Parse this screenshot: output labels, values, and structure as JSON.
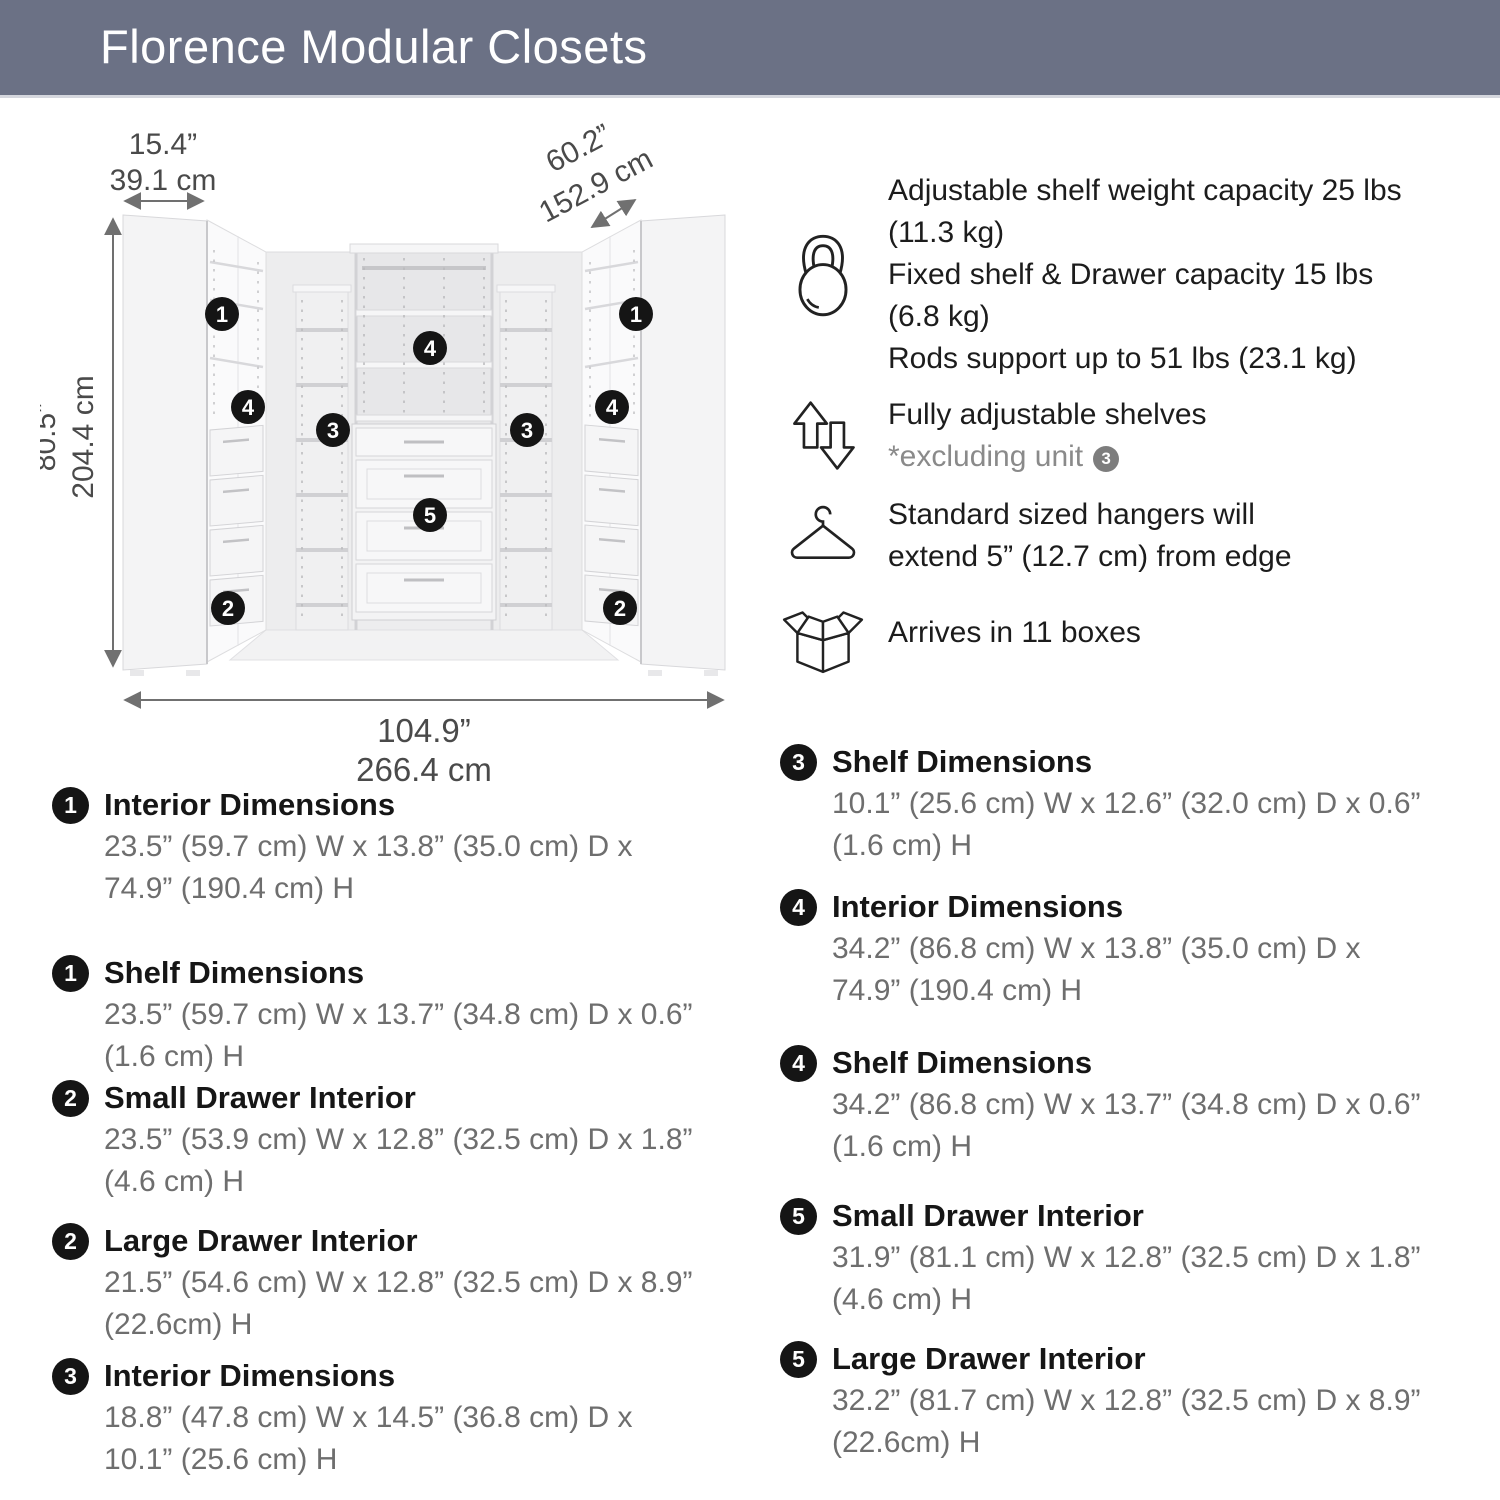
{
  "header": {
    "title": "Florence Modular Closets"
  },
  "colors": {
    "header_bg": "#6b7185",
    "badge_bg": "#151515",
    "note_badge_bg": "#7d7d7d",
    "body_gray": "#6e6e6e",
    "dimension_gray": "#4a4a4a"
  },
  "diagram": {
    "width_top_small": {
      "in": "15.4”",
      "cm": "39.1 cm"
    },
    "width_top_angled": {
      "in": "60.2”",
      "cm": "152.9 cm"
    },
    "height_left": {
      "in": "80.5”",
      "cm": "204.4 cm"
    },
    "width_bottom": {
      "in": "104.9”",
      "cm": "266.4 cm"
    },
    "callouts": {
      "c1": "1",
      "c2": "2",
      "c3": "3",
      "c4": "4",
      "c5": "5"
    }
  },
  "features": [
    {
      "icon": "kettlebell-icon",
      "lines": [
        "Adjustable shelf weight capacity 25 lbs (11.3 kg)",
        "Fixed shelf & Drawer capacity 15 lbs (6.8 kg)",
        "Rods support up to 51 lbs (23.1 kg)"
      ]
    },
    {
      "icon": "adjustable-arrows-icon",
      "title": "Fully adjustable shelves",
      "note": "*excluding unit",
      "note_badge": "3"
    },
    {
      "icon": "hanger-icon",
      "text": "Standard sized hangers will extend 5” (12.7 cm) from edge"
    },
    {
      "icon": "box-icon",
      "text": "Arrives in 11 boxes"
    }
  ],
  "specs": {
    "left": [
      {
        "badge": "1",
        "title": "Interior Dimensions",
        "dims": "23.5” (59.7 cm) W x 13.8” (35.0 cm) D x 74.9” (190.4 cm) H"
      },
      {
        "badge": "1",
        "title": "Shelf Dimensions",
        "dims": "23.5” (59.7 cm) W x 13.7” (34.8 cm) D x 0.6” (1.6 cm) H"
      },
      {
        "badge": "2",
        "title": "Small Drawer Interior",
        "dims": "23.5” (53.9 cm) W x 12.8” (32.5 cm) D x 1.8” (4.6 cm) H"
      },
      {
        "badge": "2",
        "title": "Large Drawer Interior",
        "dims": "21.5” (54.6 cm) W x 12.8” (32.5 cm) D x 8.9” (22.6cm) H"
      },
      {
        "badge": "3",
        "title": "Interior Dimensions",
        "dims": "18.8” (47.8 cm) W x 14.5” (36.8 cm) D x 10.1” (25.6 cm) H"
      }
    ],
    "right": [
      {
        "badge": "3",
        "title": "Shelf Dimensions",
        "dims": "10.1” (25.6 cm) W x 12.6” (32.0 cm) D x 0.6” (1.6 cm) H"
      },
      {
        "badge": "4",
        "title": "Interior Dimensions",
        "dims": "34.2” (86.8 cm) W x 13.8” (35.0 cm) D x 74.9” (190.4 cm) H"
      },
      {
        "badge": "4",
        "title": "Shelf Dimensions",
        "dims": "34.2” (86.8 cm) W x 13.7” (34.8 cm) D x 0.6” (1.6 cm) H"
      },
      {
        "badge": "5",
        "title": "Small Drawer Interior",
        "dims": "31.9” (81.1 cm) W x 12.8” (32.5 cm) D x 1.8” (4.6 cm) H"
      },
      {
        "badge": "5",
        "title": "Large Drawer Interior",
        "dims": "32.2” (81.7 cm) W x 12.8” (32.5 cm) D x 8.9” (22.6cm) H"
      }
    ]
  }
}
